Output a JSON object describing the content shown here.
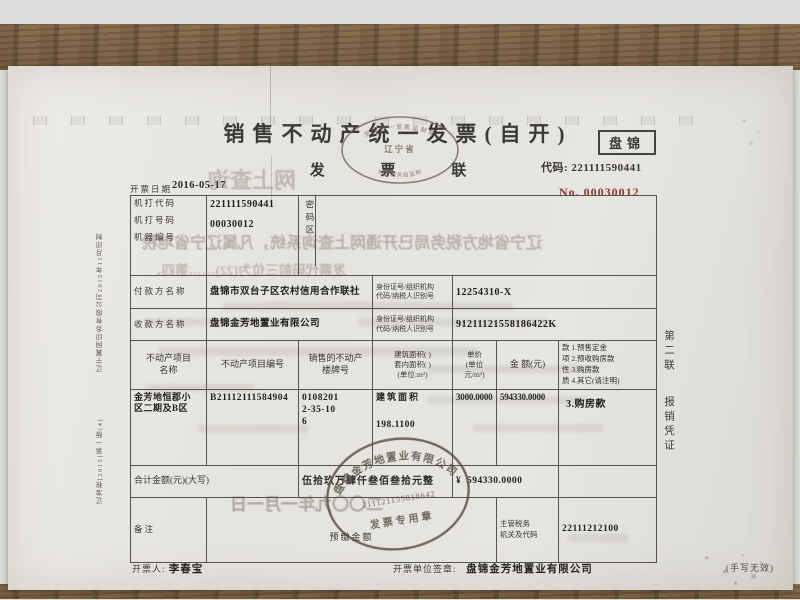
{
  "colors": {
    "invoice_no_red": "#8a3a2c",
    "seal_ink": "#564c42",
    "print_ink": "#2c2a26"
  },
  "doc": {
    "title": "销售不动产统一发票(自开)",
    "copy_label": "发 票 联",
    "city": "盘锦",
    "code_label": "代码:",
    "code": "221111590441",
    "no_label": "No.",
    "no": "00030012",
    "date_label": "开票日期",
    "date": "2016-05-17"
  },
  "supervision_stamp": {
    "ring": "全国统一发票监制章",
    "center": "辽宁省",
    "bottom": "地方税务局监制"
  },
  "table": {
    "machine_code_label": "机打代码",
    "machine_code": "221111590441",
    "machine_no_label": "机打号码",
    "machine_no": "00030012",
    "machine_id_label": "机器编号",
    "password_label": "密码区",
    "payer_label": "付款方名称",
    "payer": "盘锦市双台子区农村信用合作联社",
    "id_label_line1": "身份证号/组织机构",
    "id_label_line2": "代码/纳税人识别号",
    "payer_id": "12254310-X",
    "payee_label": "收款方名称",
    "payee": "盘锦金芳地置业有限公司",
    "payee_id": "91211121558186422K",
    "col_project_name_l1": "不动产项目",
    "col_project_name_l2": "名称",
    "col_project_no": "不动产项目编号",
    "col_building_no_l1": "销售的不动产",
    "col_building_no_l2": "楼牌号",
    "col_area_l1": "建筑面积(  )",
    "col_area_l2": "套内面积(  )",
    "col_area_l3": "(单位:m²)",
    "col_price_l1": "单价",
    "col_price_l2": "(单位",
    "col_price_l3": "元/m²)",
    "col_amount": "金 额(元)",
    "nature_lines": [
      "款 1.预售定金",
      "项 2.预收购房款",
      "性 3.购房款",
      "质 4.其它(请注明)"
    ],
    "row": {
      "project_name_l1": "金芳地恒郡小",
      "project_name_l2": "区二期及B区",
      "project_no": "B21112111584904",
      "building_no_l1": "0108201",
      "building_no_l2": "2-35-10",
      "building_no_l3": "6",
      "area_label": "建筑面积",
      "area": "198.1100",
      "unit_price": "3000.0000",
      "amount": "594330.0000",
      "nature": "3.购房款"
    },
    "total_label": "合计金额(元)(大写)",
    "total_cn": "伍拾玖万肆仟叁佰叁拾元整",
    "currency": "¥",
    "total": "594330.0000",
    "remark_label": "备注",
    "prepaid_label": "预缴金额",
    "tax_org_label_l1": "主管税务",
    "tax_org_label_l2": "机关及代码",
    "tax_org_code": "22111212100"
  },
  "seal": {
    "company": "盘锦金芳地置业有限公司",
    "number": "211121155818642",
    "type": "发票专用章"
  },
  "footer": {
    "issuer_label": "开票人:",
    "issuer": "李春宝",
    "unit_label": "开票单位签章:",
    "unit": "盘锦金芳地置业有限公司",
    "note": "(手写无效)"
  },
  "side_right_l1": "第二联",
  "side_right_l2": "报销凭证",
  "side_left_l1": "辽宁翼网印务有限公司2015年11月印制",
  "side_left_l2": "辽准税[2015]第一版(4)",
  "ghost": {
    "fragments": [
      {
        "text": "网上查询",
        "x": 200,
        "y": 97,
        "size": 22,
        "opacity": 0.36
      },
      {
        "text": "辽宁省地方税务局已开通网上查询系统，凡属辽宁省地税",
        "x": 134,
        "y": 163,
        "size": 16,
        "opacity": 0.42
      },
      {
        "text": "发票代码前三位为(22)……第四、",
        "x": 140,
        "y": 193,
        "size": 13.5,
        "opacity": 0.36
      },
      {
        "text": "二〇〇九年一月一日",
        "x": 222,
        "y": 424,
        "size": 17,
        "opacity": 0.5
      }
    ]
  }
}
